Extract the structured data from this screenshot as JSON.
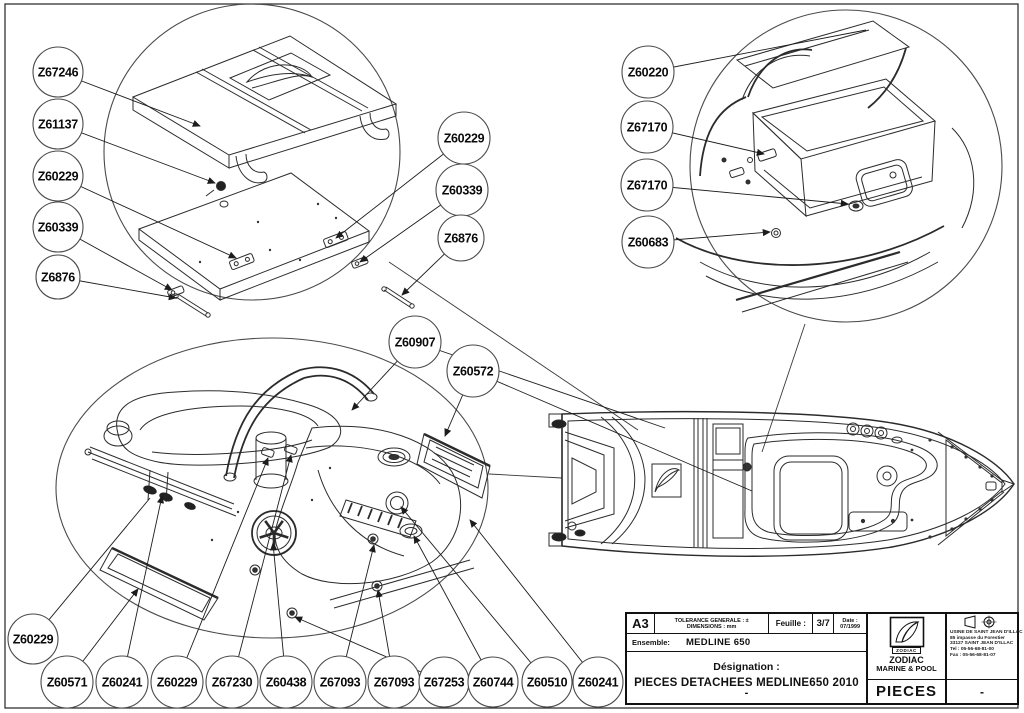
{
  "title_block": {
    "format": "A3",
    "tolerance_line1": "TOLERANCE GENERALE : ±",
    "tolerance_line2": "DIMENSIONS : mm",
    "sheet_label": "Feuille :",
    "sheet_value": "3/7",
    "date_label": "Date :",
    "date_value": "07/1999",
    "ensemble_label": "Ensemble:",
    "ensemble_value": "MEDLINE 650",
    "designation_label": "Désignation :",
    "designation_value": "PIECES DETACHEES MEDLINE650 2010",
    "designation_suffix": "-",
    "logo_text": "ZODIAC",
    "company_line1": "ZODIAC",
    "company_line2": "MARINE & POOL",
    "doc_type": "PIECES",
    "revision": "-",
    "address_lines": [
      "USINE DE SAINT JEAN D'ILLAC",
      "85 impasse du Forestier",
      "33127 SAINT JEAN D'ILLAC",
      "Tel : 05-56-68-81-00",
      "Fax : 05-56-68-81-07"
    ]
  },
  "callouts": [
    {
      "label": "Z67246",
      "x": 58,
      "y": 72,
      "r": 25,
      "leaders": [
        {
          "x": 200,
          "y": 126,
          "arrow": true
        }
      ]
    },
    {
      "label": "Z61137",
      "x": 58,
      "y": 124,
      "r": 25,
      "leaders": [
        {
          "x": 215,
          "y": 183,
          "arrow": true
        }
      ]
    },
    {
      "label": "Z60229",
      "x": 58,
      "y": 176,
      "r": 25,
      "leaders": [
        {
          "x": 236,
          "y": 258,
          "arrow": true
        }
      ]
    },
    {
      "label": "Z60339",
      "x": 58,
      "y": 227,
      "r": 25,
      "leaders": [
        {
          "x": 172,
          "y": 290,
          "arrow": true
        }
      ]
    },
    {
      "label": "Z6876",
      "x": 58,
      "y": 277,
      "r": 22,
      "leaders": [
        {
          "x": 176,
          "y": 298,
          "arrow": true
        }
      ]
    },
    {
      "label": "Z60229",
      "x": 464,
      "y": 138,
      "r": 26,
      "leaders": [
        {
          "x": 336,
          "y": 238,
          "arrow": true
        }
      ]
    },
    {
      "label": "Z60339",
      "x": 462,
      "y": 190,
      "r": 26,
      "leaders": [
        {
          "x": 360,
          "y": 262,
          "arrow": true
        }
      ]
    },
    {
      "label": "Z6876",
      "x": 461,
      "y": 238,
      "r": 23,
      "leaders": [
        {
          "x": 402,
          "y": 295,
          "arrow": true
        }
      ]
    },
    {
      "label": "Z60220",
      "x": 648,
      "y": 72,
      "r": 26,
      "leaders": [
        {
          "x": 866,
          "y": 30,
          "arrow": false
        }
      ]
    },
    {
      "label": "Z67170",
      "x": 647,
      "y": 127,
      "r": 26,
      "leaders": [
        {
          "x": 764,
          "y": 154,
          "arrow": true
        }
      ]
    },
    {
      "label": "Z67170",
      "x": 647,
      "y": 185,
      "r": 26,
      "leaders": [
        {
          "x": 848,
          "y": 204,
          "arrow": true
        }
      ]
    },
    {
      "label": "Z60683",
      "x": 648,
      "y": 242,
      "r": 26,
      "leaders": [
        {
          "x": 770,
          "y": 232,
          "arrow": true
        }
      ]
    },
    {
      "label": "Z60907",
      "x": 415,
      "y": 342,
      "r": 26,
      "leaders": [
        {
          "x": 352,
          "y": 410,
          "arrow": true
        },
        {
          "x": 665,
          "y": 428,
          "arrow": false
        }
      ]
    },
    {
      "label": "Z60572",
      "x": 473,
      "y": 371,
      "r": 26,
      "leaders": [
        {
          "x": 445,
          "y": 436,
          "arrow": true
        },
        {
          "x": 752,
          "y": 491,
          "arrow": false
        }
      ]
    },
    {
      "label": "Z60229",
      "x": 33,
      "y": 639,
      "r": 25,
      "leaders": [
        {
          "x": 150,
          "y": 498,
          "arrow": false
        }
      ]
    },
    {
      "label": "Z60571",
      "x": 67,
      "y": 682,
      "r": 26,
      "leaders": [
        {
          "x": 138,
          "y": 589,
          "arrow": true
        }
      ]
    },
    {
      "label": "Z60241",
      "x": 122,
      "y": 682,
      "r": 26,
      "leaders": [
        {
          "x": 162,
          "y": 496,
          "arrow": true
        }
      ]
    },
    {
      "label": "Z60229",
      "x": 177,
      "y": 682,
      "r": 26,
      "leaders": [
        {
          "x": 268,
          "y": 458,
          "arrow": true
        }
      ]
    },
    {
      "label": "Z67230",
      "x": 232,
      "y": 682,
      "r": 26,
      "leaders": [
        {
          "x": 291,
          "y": 455,
          "arrow": true
        }
      ]
    },
    {
      "label": "Z60438",
      "x": 286,
      "y": 682,
      "r": 26,
      "leaders": [
        {
          "x": 273,
          "y": 543,
          "arrow": true
        }
      ]
    },
    {
      "label": "Z67093",
      "x": 340,
      "y": 682,
      "r": 26,
      "leaders": [
        {
          "x": 374,
          "y": 545,
          "arrow": true
        }
      ]
    },
    {
      "label": "Z67093",
      "x": 394,
      "y": 682,
      "r": 26,
      "leaders": [
        {
          "x": 378,
          "y": 590,
          "arrow": true
        }
      ]
    },
    {
      "label": "Z67253",
      "x": 444,
      "y": 682,
      "r": 25,
      "leaders": [
        {
          "x": 295,
          "y": 617,
          "arrow": true
        }
      ]
    },
    {
      "label": "Z60744",
      "x": 493,
      "y": 682,
      "r": 25,
      "leaders": [
        {
          "x": 414,
          "y": 536,
          "arrow": true
        }
      ]
    },
    {
      "label": "Z60510",
      "x": 547,
      "y": 682,
      "r": 25,
      "leaders": [
        {
          "x": 401,
          "y": 507,
          "arrow": true
        }
      ]
    },
    {
      "label": "Z60241",
      "x": 598,
      "y": 682,
      "r": 25,
      "leaders": [
        {
          "x": 470,
          "y": 520,
          "arrow": true
        }
      ]
    }
  ]
}
